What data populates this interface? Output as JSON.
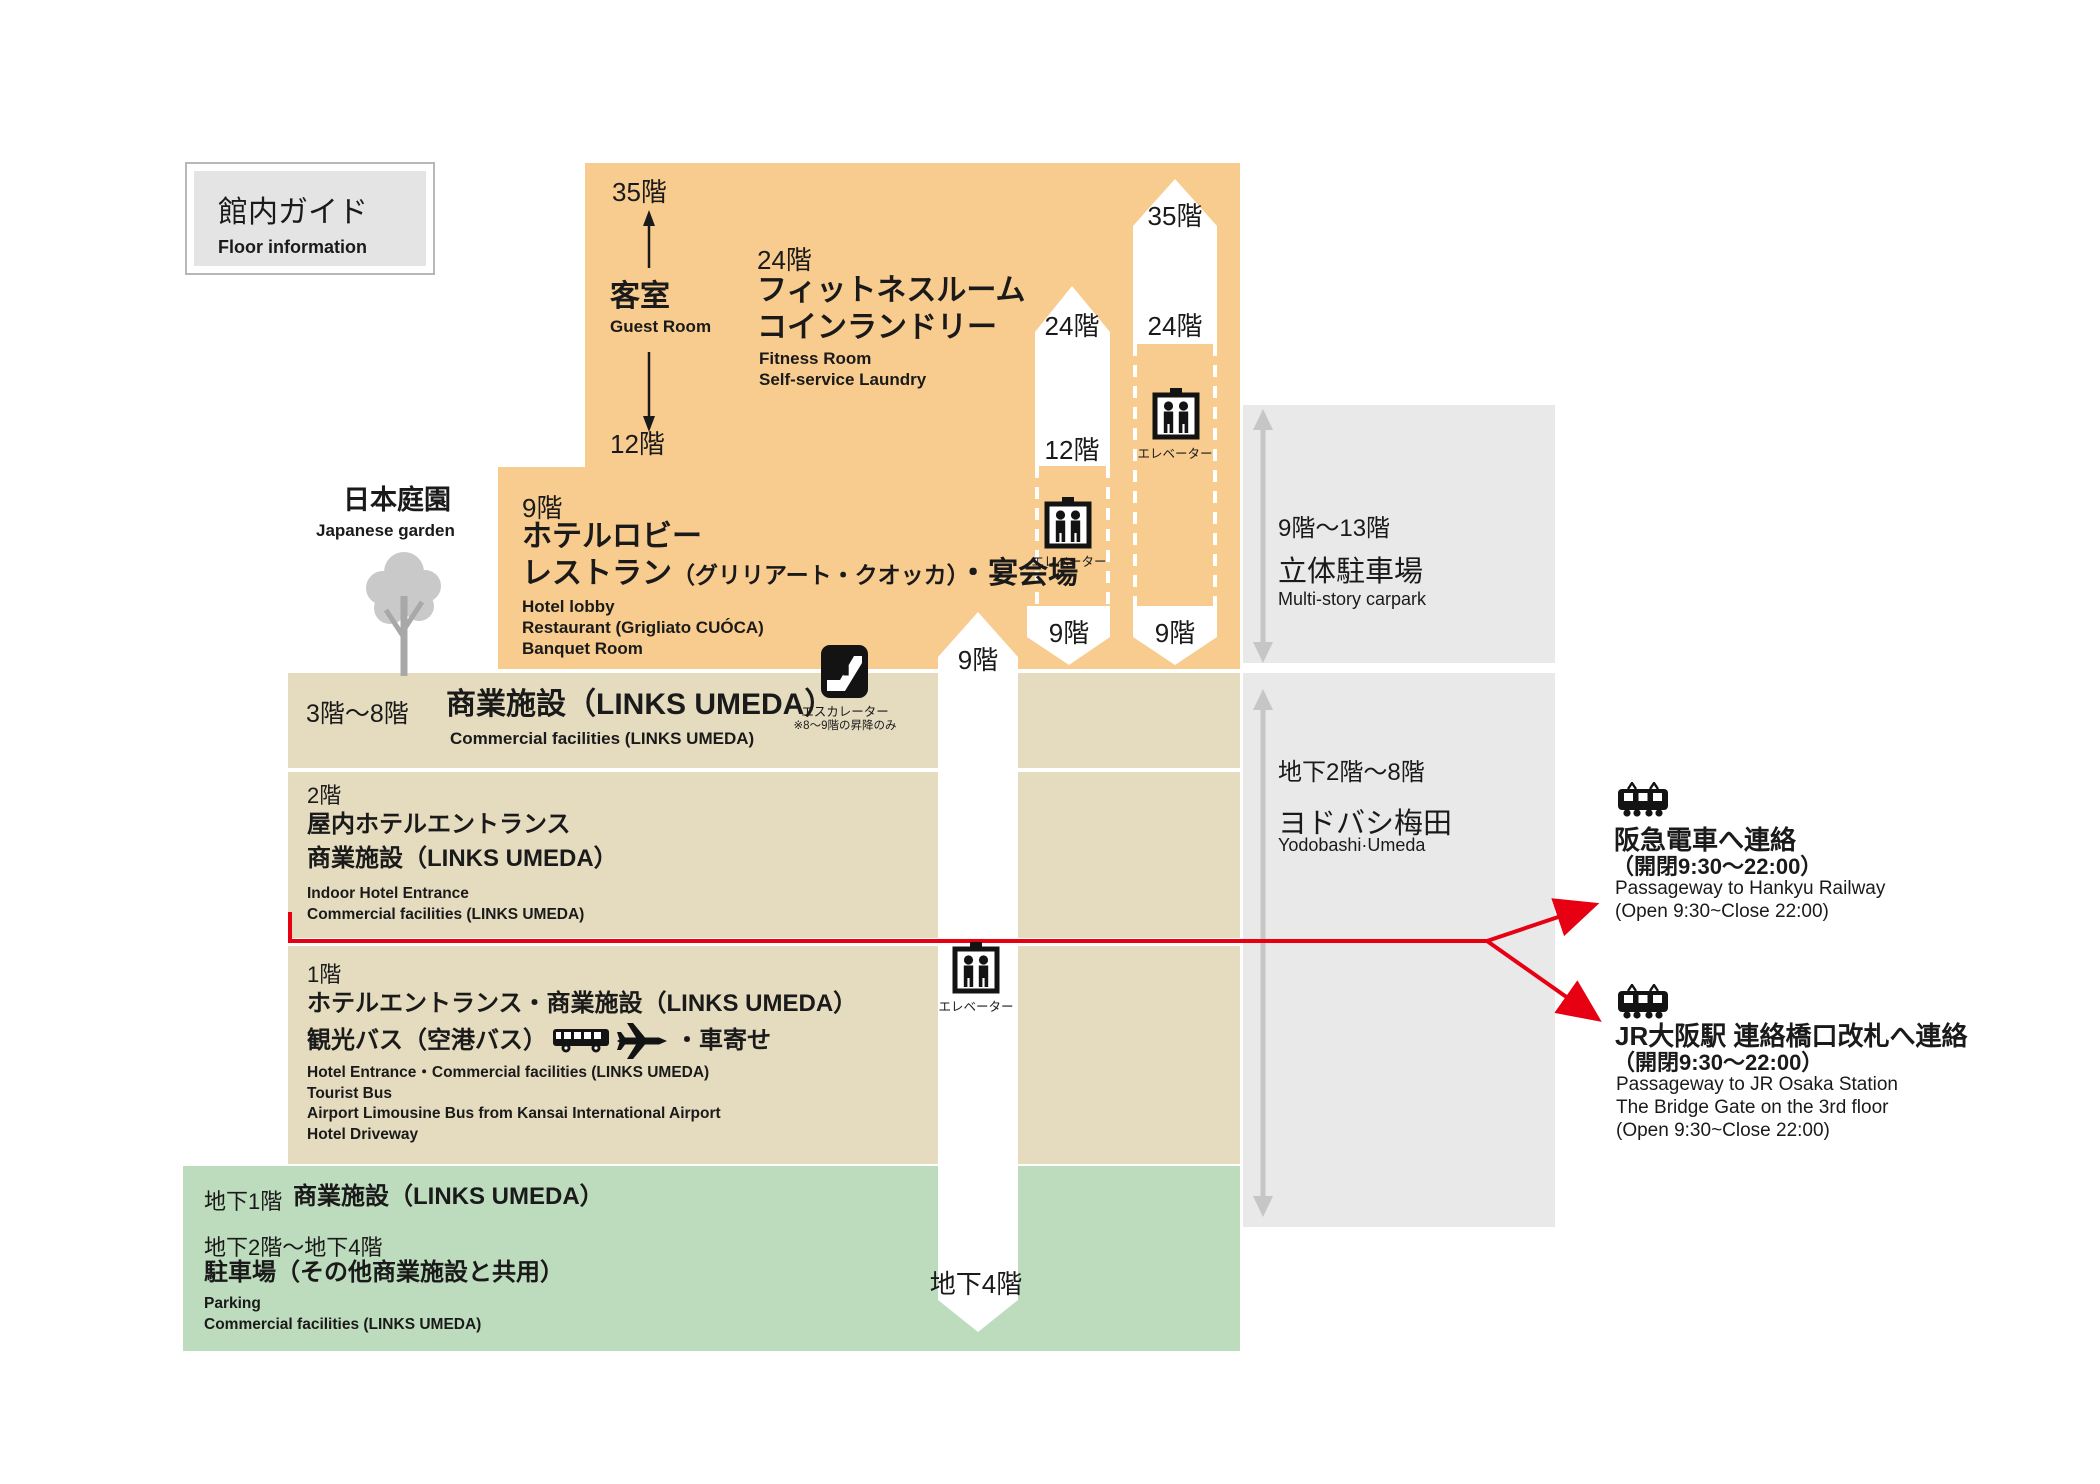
{
  "title_box": {
    "jp": "館内ガイド",
    "en": "Floor information"
  },
  "guest_room": {
    "top_floor": "35階",
    "jp": "客室",
    "en": "Guest Room",
    "bottom_floor": "12階"
  },
  "fitness": {
    "floor": "24階",
    "jp1": "フィットネスルーム",
    "jp2": "コインランドリー",
    "en1": "Fitness Room",
    "en2": "Self-service Laundry"
  },
  "floor9": {
    "floor": "9階",
    "jp1": "ホテルロビー",
    "jp2a": "レストラン",
    "jp2b": "（グリリアート・クオッカ）",
    "jp2c": "・宴会場",
    "en1": "Hotel lobby",
    "en2": "Restaurant (Grigliato CUÓCA)",
    "en3": "Banquet Room"
  },
  "garden": {
    "jp": "日本庭園",
    "en": "Japanese garden"
  },
  "floors3to8": {
    "range": "3階〜8階",
    "jp": "商業施設（LINKS UMEDA）",
    "en": "Commercial facilities (LINKS UMEDA)"
  },
  "escalator": {
    "label": "エスカレーター",
    "note": "※8〜9階の昇降のみ"
  },
  "floor2": {
    "floor": "2階",
    "jp1": "屋内ホテルエントランス",
    "jp2": "商業施設（LINKS UMEDA）",
    "en1": "Indoor Hotel Entrance",
    "en2": "Commercial facilities (LINKS UMEDA)"
  },
  "floor1": {
    "floor": "1階",
    "jp1": "ホテルエントランス・商業施設（LINKS UMEDA）",
    "jp2a": "観光バス（空港バス）",
    "jp2b": "・車寄せ",
    "en1": "Hotel Entrance・Commercial facilities (LINKS UMEDA)",
    "en2": "Tourist Bus",
    "en3": "Airport Limousine Bus from Kansai International Airport",
    "en4": "Hotel Driveway"
  },
  "basement": {
    "b1_floor": "地下1階",
    "b1_jp": "商業施設（LINKS UMEDA）",
    "b2_floor": "地下2階〜地下4階",
    "b2_jp": "駐車場（その他商業施設と共用）",
    "en1": "Parking",
    "en2": "Commercial facilities (LINKS UMEDA)"
  },
  "carpark": {
    "range": "9階〜13階",
    "jp": "立体駐車場",
    "en": "Multi-story carpark"
  },
  "yodobashi": {
    "range": "地下2階〜8階",
    "jp": "ヨドバシ梅田",
    "en": "Yodobashi·Umeda"
  },
  "shaft_left": {
    "top_floor": "24階",
    "bottom_floor": "12階",
    "elevator_label": "エレベーター",
    "exit_floor": "9階"
  },
  "shaft_right": {
    "top_floor": "35階",
    "mid_floor": "24階",
    "elevator_label": "エレベーター",
    "exit_floor": "9階"
  },
  "shaft_center": {
    "top_floor": "9階",
    "elevator_label": "エレベーター",
    "bottom_floor": "地下4階"
  },
  "hankyu": {
    "jp": "阪急電車へ連絡",
    "jp_hours": "（開閉9:30〜22:00）",
    "en1": "Passageway to Hankyu Railway",
    "en2": "(Open 9:30~Close 22:00)"
  },
  "jr": {
    "jp": "JR大阪駅 連絡橋口改札へ連絡",
    "jp_hours": "（開閉9:30〜22:00）",
    "en1": "Passageway to JR Osaka Station",
    "en2": "The Bridge Gate on the 3rd floor",
    "en3": "(Open 9:30~Close 22:00)"
  },
  "colors": {
    "orange": "#F8CC8E",
    "tan": "#E5DCC0",
    "green": "#BDDBBD",
    "gray_box": "#E9E9E9",
    "red": "#E60012",
    "icon_black": "#131313",
    "tree_foliage": "#c9c9c9",
    "tree_trunk": "#a8a8a8"
  }
}
